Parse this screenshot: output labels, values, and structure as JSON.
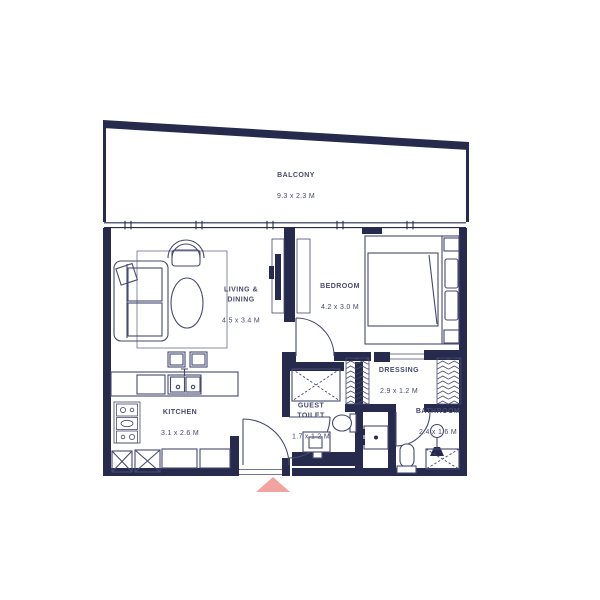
{
  "plan_type": "apartment-floor-plan",
  "rooms": {
    "balcony": {
      "label": "BALCONY",
      "dims": "9.3 x 2.3 M"
    },
    "living": {
      "label": "LIVING &\nDINING",
      "dims": "4.5 x 3.4 M"
    },
    "bedroom": {
      "label": "BEDROOM",
      "dims": "4.2 x 3.0 M"
    },
    "kitchen": {
      "label": "KITCHEN",
      "dims": "3.1 x 2.6 M"
    },
    "guest_toilet": {
      "label": "GUEST\nTOILET",
      "dims": "1.7 x 1.2 M"
    },
    "dressing": {
      "label": "DRESSING",
      "dims": "2.9 x 1.2 M"
    },
    "bathroom": {
      "label": "BATHROOM",
      "dims": "2.4 x 1.6 M"
    }
  },
  "colors": {
    "wall": "#262b4e",
    "furniture": "#454a6e",
    "light_line": "#6a6f8e",
    "text": "#454a6e",
    "entrance_arrow": "#f2a39e",
    "background": "#ffffff"
  }
}
